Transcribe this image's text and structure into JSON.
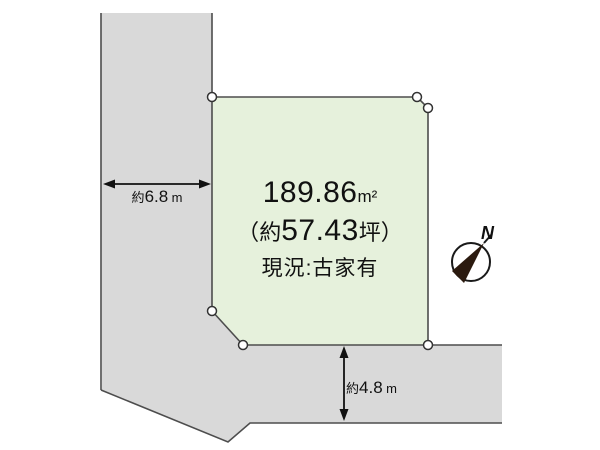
{
  "diagram": {
    "type": "land-plot-site-plan",
    "plot": {
      "area_value": "189.86",
      "area_unit": "m²",
      "tsubo_open": "（",
      "tsubo_approx": "約",
      "tsubo_value": "57.43",
      "tsubo_unit": "坪",
      "tsubo_close": "）",
      "status": "現況:古家有"
    },
    "dimensions": {
      "left_road": {
        "approx": "約",
        "value": "6.8",
        "unit": "m"
      },
      "bottom_road": {
        "approx": "約",
        "value": "4.8",
        "unit": "m"
      }
    },
    "compass": {
      "north_label": "N"
    },
    "colors": {
      "road_fill": "#d9d9d9",
      "plot_fill": "#e6f1dc",
      "outline": "#4d4d4d",
      "marker_stroke": "#333333",
      "marker_fill": "#ffffff",
      "arrow": "#111111",
      "compass_ring": "#1a1a1a",
      "compass_needle": "#2b1a0f",
      "text": "#111111",
      "background": "#ffffff"
    }
  }
}
